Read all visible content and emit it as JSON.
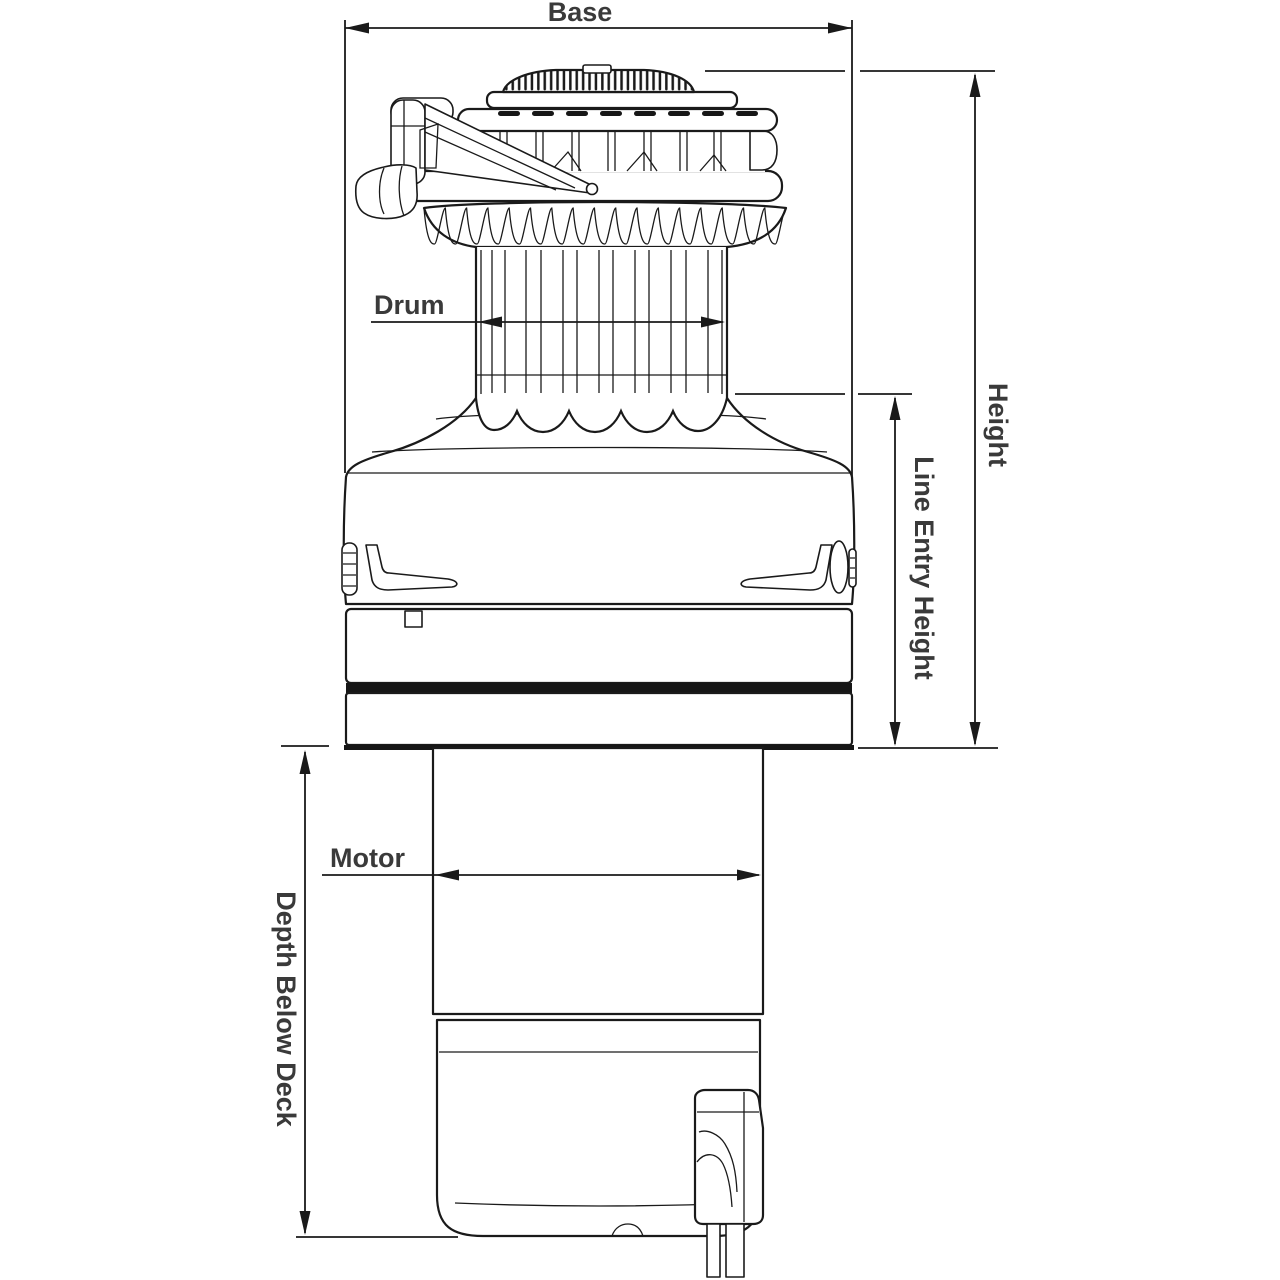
{
  "diagram": {
    "type": "technical-dimension-drawing",
    "subject": "electric-winch-side-elevation",
    "labels": {
      "base": "Base",
      "height": "Height",
      "line_entry_height": "Line Entry Height",
      "drum": "Drum",
      "motor": "Motor",
      "depth_below_deck": "Depth Below Deck"
    },
    "colors": {
      "line": "#1a1a1a",
      "text": "#3a3a3a",
      "background": "#ffffff"
    }
  }
}
